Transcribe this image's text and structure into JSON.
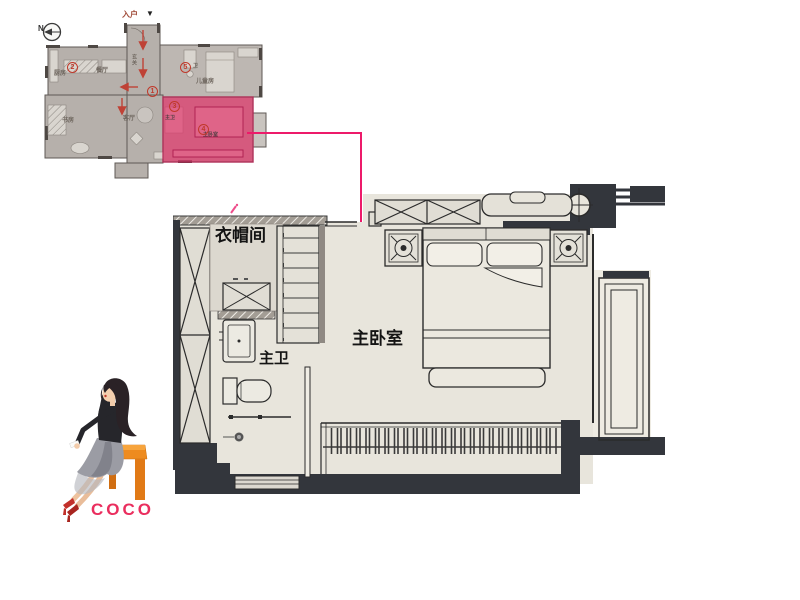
{
  "overview": {
    "compass_n": "N",
    "entrance": {
      "label": "入户",
      "arrow": "▼"
    },
    "rooms": {
      "kitchen": "厨房",
      "dining": "餐厅",
      "hall": "玄关",
      "study": "书房",
      "living": "客厅",
      "kids": "儿童房",
      "bath": "卫",
      "master_bath": "主卫",
      "master_bed": "主卧室"
    },
    "markers": {
      "m1": "1",
      "m2": "2",
      "m3": "3",
      "m4": "4",
      "m5": "5"
    },
    "highlight_color": "#e23a6e"
  },
  "main_plan": {
    "labels": {
      "cloakroom": "衣帽间",
      "master_bath": "主卫",
      "master_bedroom": "主卧室"
    }
  },
  "branding": {
    "logo": "COCO"
  },
  "colors": {
    "highlight": "#e23a6e",
    "leader_line": "#ed1a6a",
    "wall_dark": "#33363c",
    "floor_light": "#e8e5dc",
    "overview_floor": "#b6b0ab",
    "marker_red": "#c0392b",
    "logo_pink": "#ea2e5e",
    "bench_orange": "#ee8b1f"
  }
}
